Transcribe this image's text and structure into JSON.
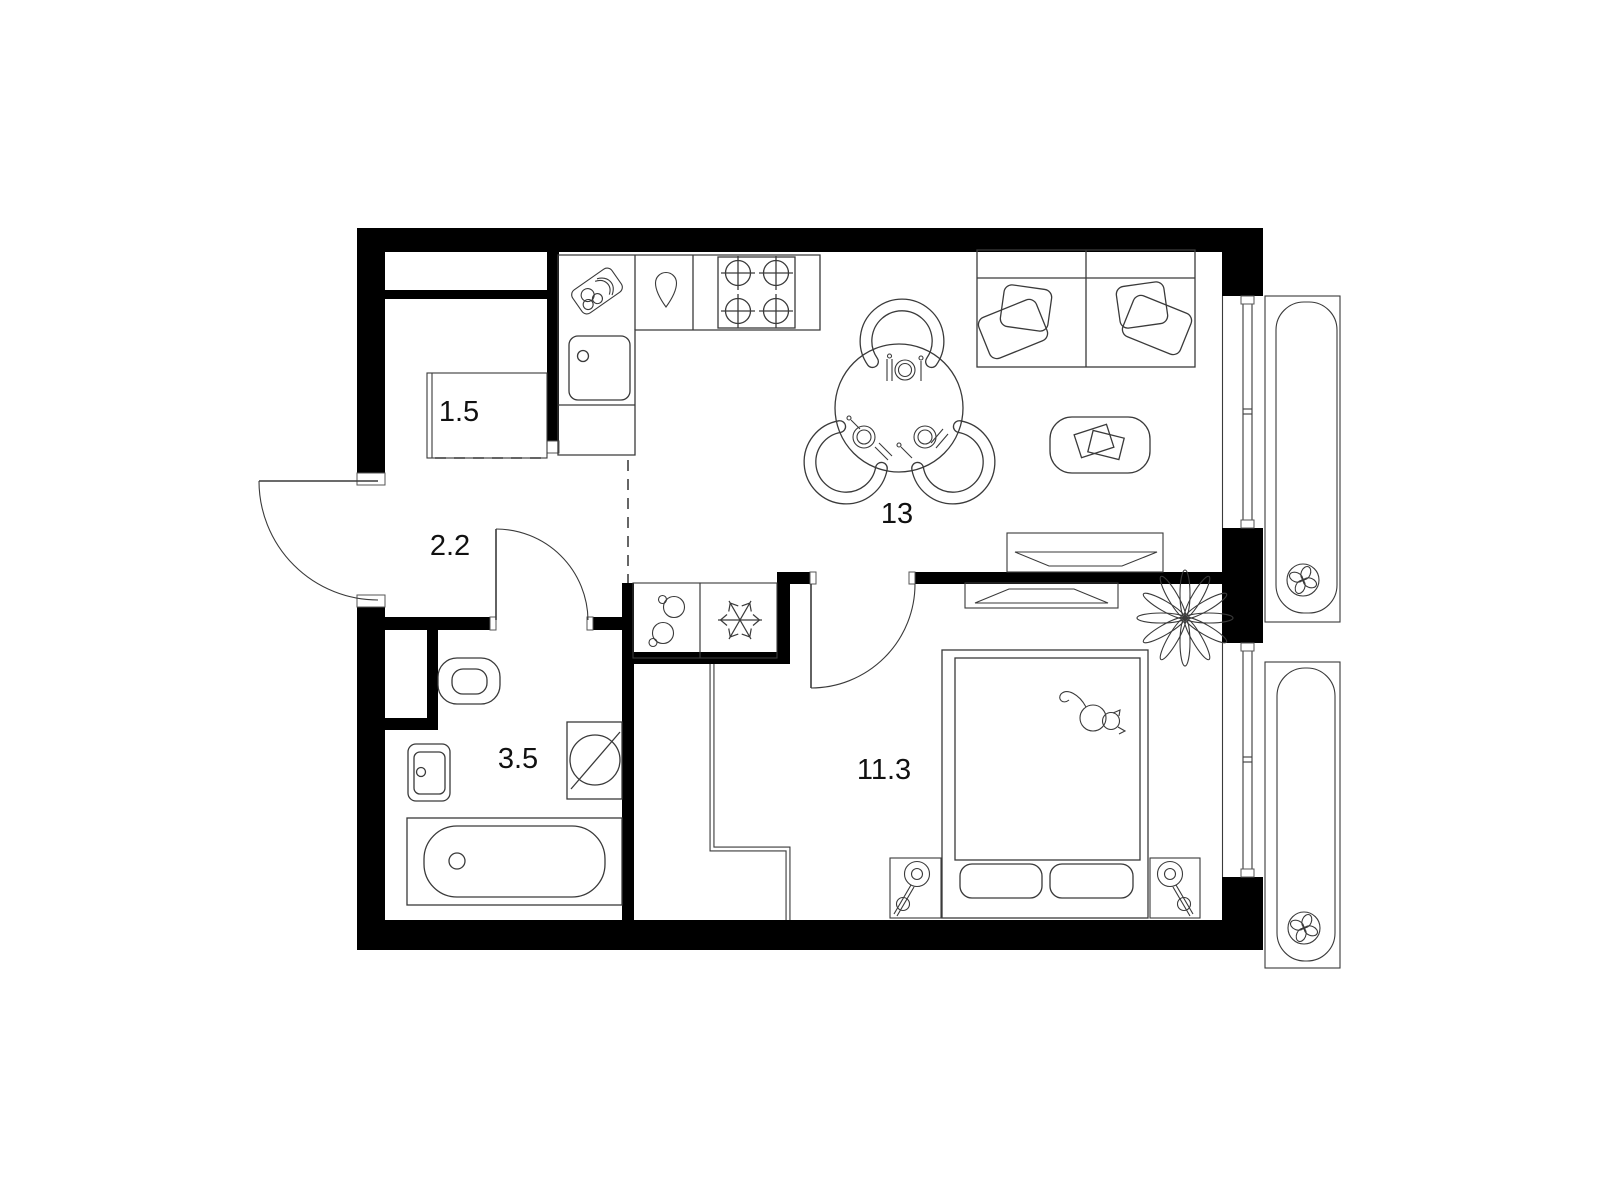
{
  "floor_plan": {
    "background_color": "#ffffff",
    "wall_color": "#000000",
    "line_color": "#3a3a3a",
    "rooms": [
      {
        "name": "wardrobe",
        "area_label": "1.5"
      },
      {
        "name": "hallway",
        "area_label": "2.2"
      },
      {
        "name": "bathroom",
        "area_label": "3.5"
      },
      {
        "name": "kitchen-living-room",
        "area_label": "13"
      },
      {
        "name": "bedroom",
        "area_label": "11.3"
      }
    ],
    "icons": [
      "cutting-board-icon",
      "kettle-icon",
      "stove-icon",
      "kitchen-sink-icon",
      "pots-icon",
      "fridge-snowflake-icon",
      "toilet-icon",
      "washbasin-icon",
      "bathtub-icon",
      "washing-machine-icon",
      "dining-table-icon",
      "chair-icon",
      "sofa-icon",
      "coffee-table-icon",
      "tv-icon",
      "bed-icon",
      "cat-icon",
      "plant-icon",
      "nightstand-lamp-icon",
      "fan-icon",
      "door-swing-icon",
      "window-icon"
    ]
  }
}
